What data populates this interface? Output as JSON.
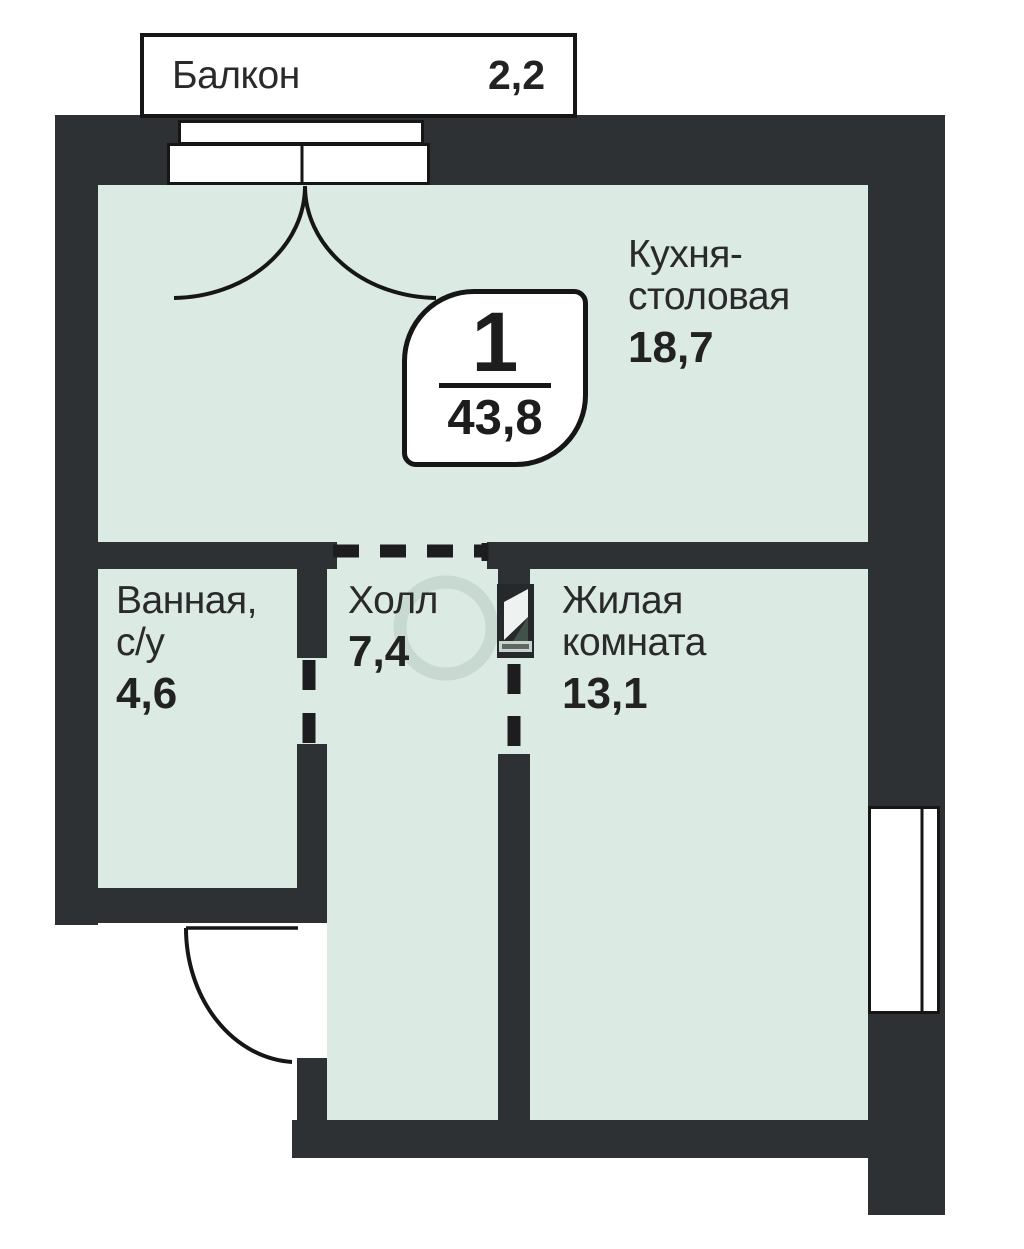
{
  "balcony_tag": {
    "name": "Балкон",
    "area": "2,2"
  },
  "badge": {
    "rooms_count": "1",
    "total_area": "43,8"
  },
  "rooms": {
    "kitchen": {
      "line1": "Кухня-",
      "line2": "столовая",
      "area": "18,7"
    },
    "bathroom": {
      "line1": "Ванная,",
      "line2": "с/у",
      "area": "4,6"
    },
    "hall": {
      "line1": "Холл",
      "area": "7,4"
    },
    "living": {
      "line1": "Жилая",
      "line2": "комната",
      "area": "13,1"
    }
  },
  "colors": {
    "wall": "#2e3133",
    "floor": "#dceae4",
    "outline": "#161616",
    "text": "#2a2a2a"
  }
}
